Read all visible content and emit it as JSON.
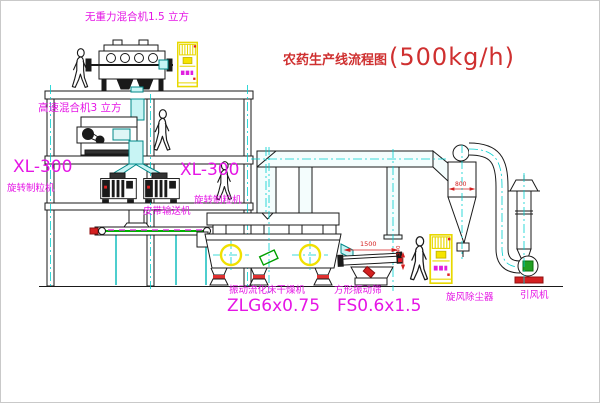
{
  "diagram": {
    "title": {
      "name": "农药生产线流程图",
      "capacity": "(500kg/h)"
    },
    "labels": {
      "gravity_free_mixer": "无重力混合机1.5 立方",
      "high_speed_mixer": "高速混合机3 立方",
      "granulator_left_model": "XL-300",
      "granulator_left_name": "旋转制粒机",
      "granulator_right_model": "XL-300",
      "granulator_right_name": "旋转制粒机",
      "belt_conveyor": "皮带输送机",
      "fluid_bed_dryer_name": "振动流化床干燥机",
      "fluid_bed_dryer_model": "ZLG6x0.75",
      "square_sieve_name": "方形振动筛",
      "square_sieve_model": "FS0.6x1.5",
      "cyclone": "旋风除尘器",
      "induced_draft_fan": "引风机"
    },
    "dimensions": {
      "sieve_length": "1500",
      "sieve_height": "340",
      "cyclone_diameter": "800"
    },
    "colors": {
      "label_magenta": "#e515e5",
      "title_red": "#cf3030",
      "dim_red": "#d42020",
      "cabinet_yellow": "#e8d800",
      "pipe_cyan": "#00d5d5",
      "conveyor_green": "#00b000",
      "line_black": "#1a1a1a"
    }
  }
}
